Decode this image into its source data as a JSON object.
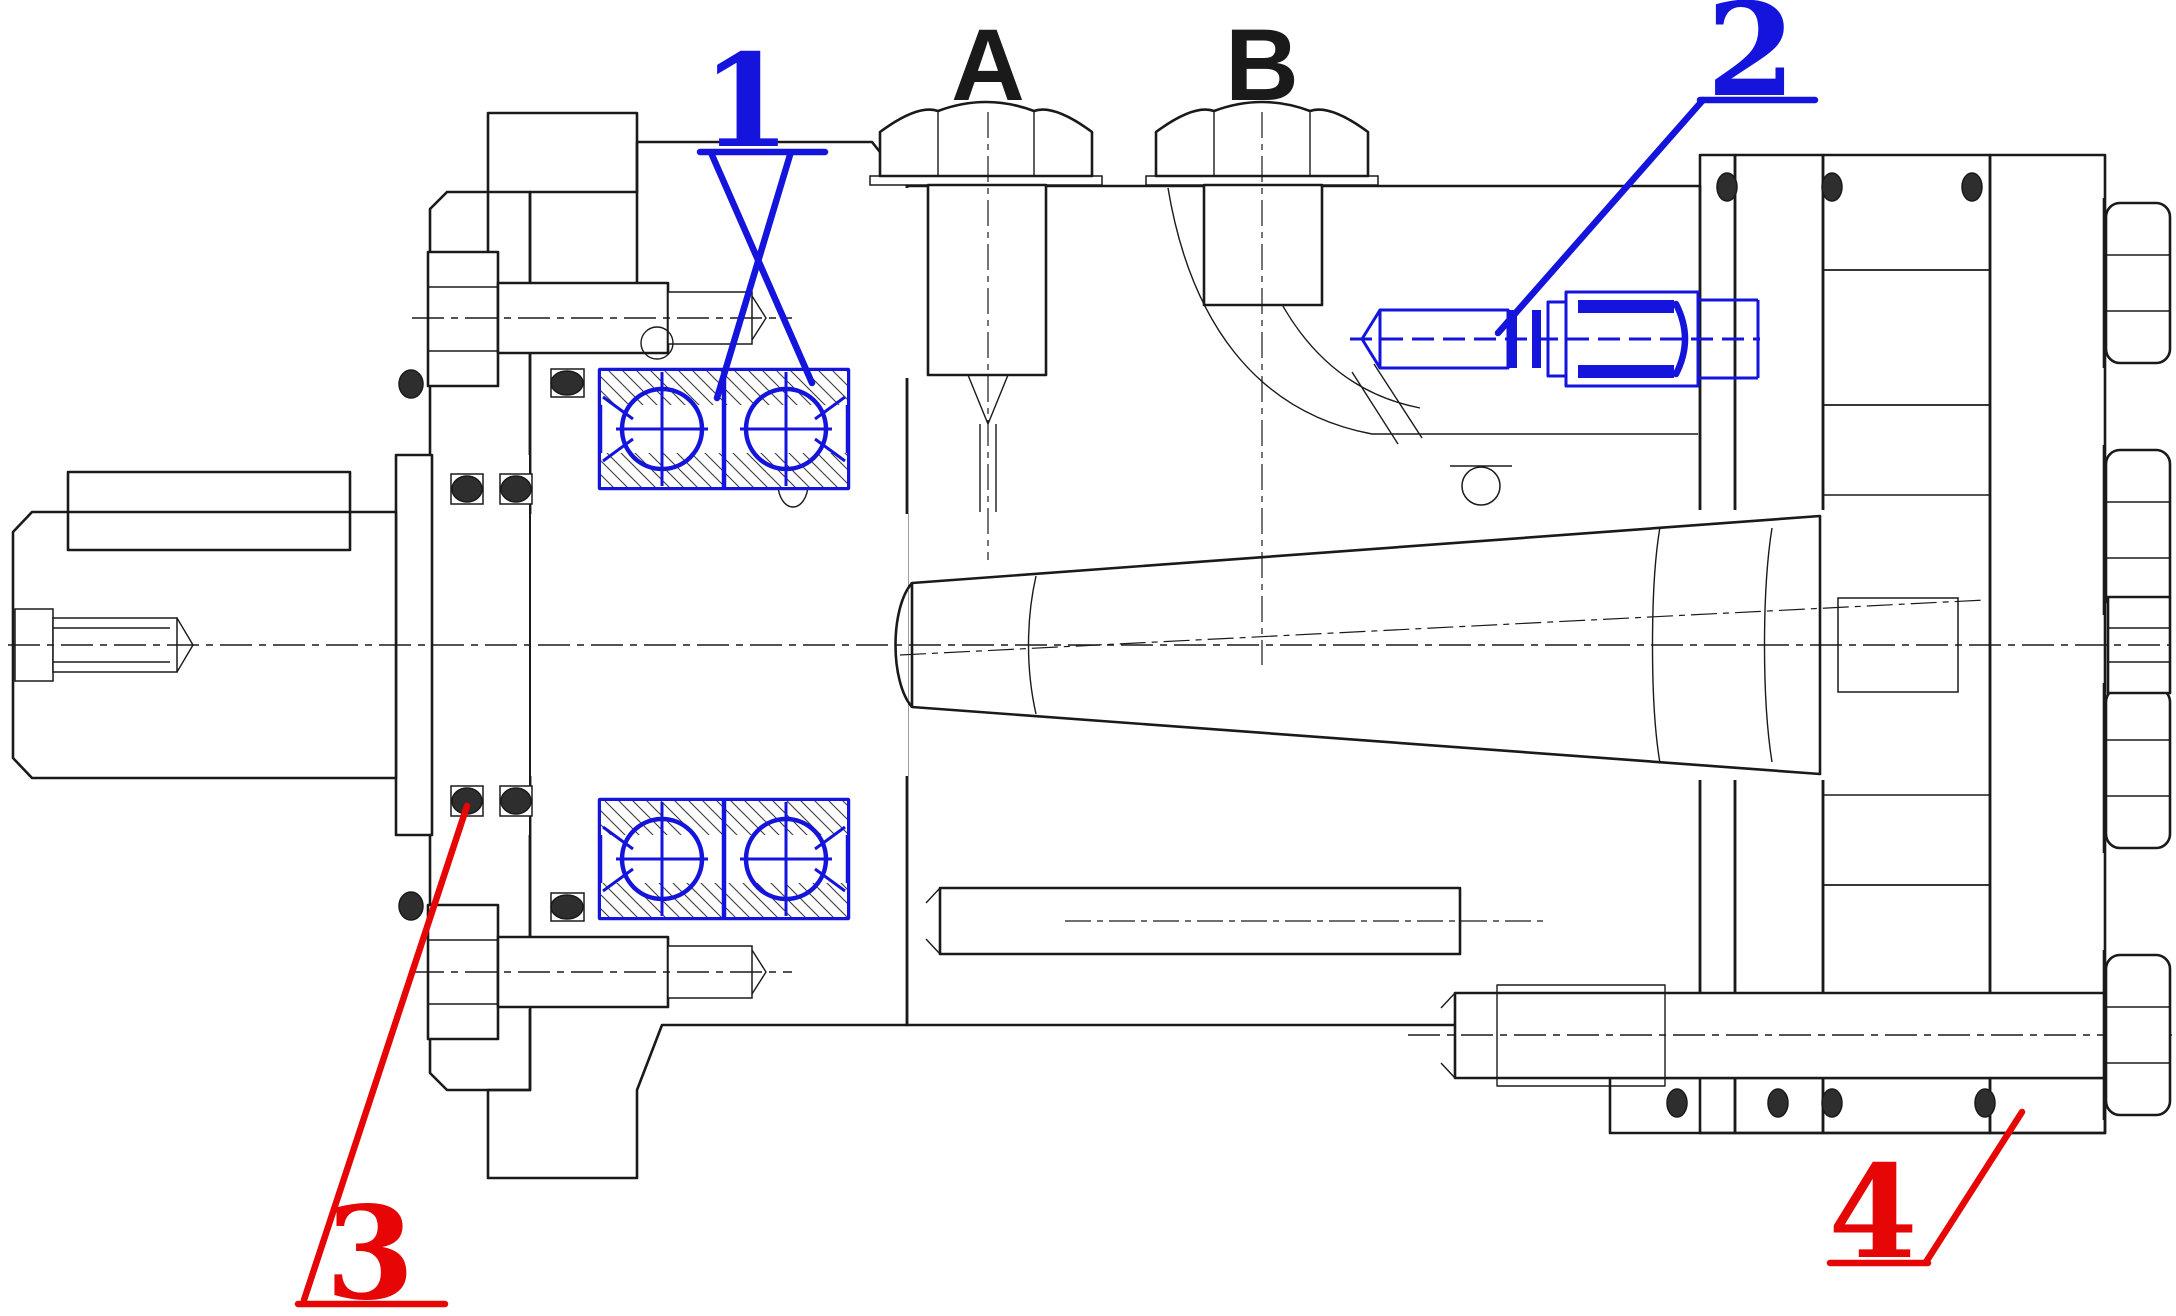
{
  "drawing": {
    "kind": "technical-cross-section",
    "subject": "hydraulic-orbital-motor-sectional-view",
    "ports": {
      "a": "A",
      "b": "B"
    },
    "callouts": {
      "c1": {
        "label": "1",
        "color": "#1414dd",
        "points_to": "tapered-roller-bearings"
      },
      "c2": {
        "label": "2",
        "color": "#1414dd",
        "points_to": "adjustment-setscrew"
      },
      "c3": {
        "label": "3",
        "color": "#e60606",
        "points_to": "shaft-seal-o-ring"
      },
      "c4": {
        "label": "4",
        "color": "#e60606",
        "points_to": "end-cover-seal"
      }
    },
    "colors": {
      "ink": "#1a1a1a",
      "highlight_blue": "#1414dd",
      "highlight_red": "#e60606",
      "seal_fill": "#2e2e2e",
      "background": "#ffffff"
    }
  }
}
